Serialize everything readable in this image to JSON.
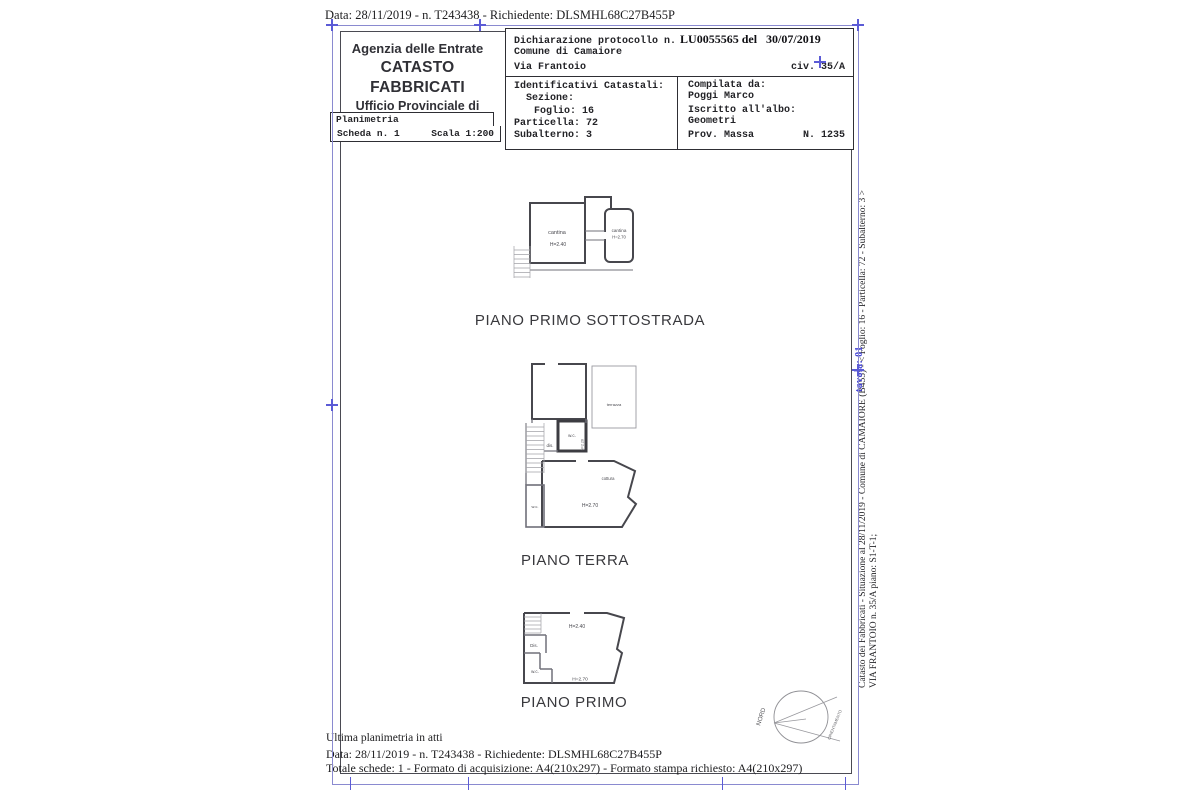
{
  "document": {
    "top_line": "Data: 28/11/2019 - n. T243438 - Richiedente: DLSMHL68C27B455P"
  },
  "header": {
    "agency": {
      "line1": "Agenzia delle Entrate",
      "line2": "CATASTO FABBRICATI",
      "line3": "Ufficio Provinciale di",
      "line4": "Lucca"
    },
    "planimetria_label": "Planimetria",
    "scheda_label": "Scheda n. 1",
    "scala_label": "Scala 1:200",
    "declaration": {
      "protocol_prefix": "Dichiarazione protocollo n.",
      "protocol_number": "LU0055565",
      "del_label": "del",
      "protocol_date": "30/07/2019",
      "comune": "Comune di Camaiore",
      "street": "Via Frantoio",
      "civic": "civ. 35/A"
    },
    "cadastral": {
      "title": "Identificativi Catastali:",
      "sezione": "Sezione:",
      "foglio": "Foglio: 16",
      "particella": "Particella: 72",
      "subalterno": "Subalterno: 3"
    },
    "compiler": {
      "compilata_da": "Compilata da:",
      "name": "Poggi Marco",
      "albo_label": "Iscritto all'albo:",
      "albo": "Geometri",
      "prov": "Prov. Massa",
      "number": "N. 1235"
    }
  },
  "plans": {
    "sottostrada": {
      "title": "PIANO PRIMO SOTTOSTRADA",
      "labels": {
        "room_left": "cantina",
        "room_left_h": "H=2.40",
        "room_right": "cantina",
        "room_right_h": "H=2.70"
      }
    },
    "terra": {
      "title": "PIANO TERRA",
      "labels": {
        "wc_top": "w.c.",
        "wc_top_h": "H=2.20",
        "dis": "dis.",
        "terrazza": "terrazza",
        "cottura": "cottura",
        "main_h": "H=2.70",
        "wc_left": "w.c."
      }
    },
    "primo": {
      "title": "PIANO PRIMO",
      "labels": {
        "h_top": "H=2.40",
        "dis": "Dis.",
        "wc": "w.c.",
        "h_main": "H=2.70"
      }
    }
  },
  "compass": {
    "north": "NORD",
    "orientation": "ORIENTAMENTO"
  },
  "side_note": {
    "line1": "Catasto dei Fabbricati - Situazione al 28/11/2019 - Comune di CAMAIORE (B455) - <  Foglio: 16 - Particella: 72 - Subalterno: 3 >",
    "line2": "VIA FRANTOIO n. 35/A piano: S1-T-1;",
    "blue_stamp": "tavola: 01"
  },
  "footer": {
    "ultima_line": "Ultima planimetria in atti",
    "data_line": "Data: 28/11/2019 - n. T243438 - Richiedente: DLSMHL68C27B455P",
    "totale_line": "Totale schede: 1 - Formato di acquisizione: A4(210x297)  - Formato stampa richiesto: A4(210x297)"
  },
  "colors": {
    "frame_blue": "#8a8ad0",
    "tick_blue": "#5b5bd6",
    "frame_black": "#4a4a52",
    "wall": "#47474d",
    "text_dark": "#1d1d1f",
    "stamp_blue": "#4343d6"
  }
}
